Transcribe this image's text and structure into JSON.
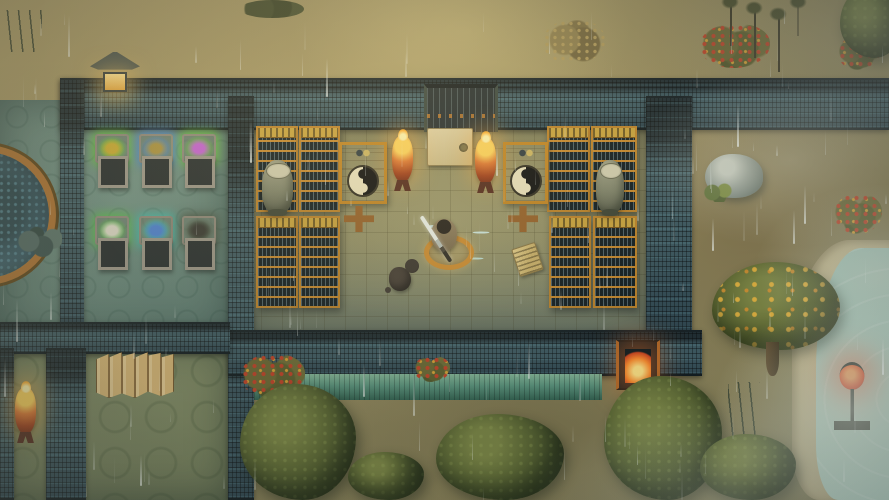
{
  "scene": {
    "view": "top-down-game-scene",
    "weather": "rain",
    "setting": "walled temple compound with scroll library, storage room, courtyard, lake shore"
  },
  "palette": {
    "dirt": "#9c8e5f",
    "wall_tile": "#2c3e46",
    "library_floor": "#8e8960",
    "teal_floor": "#67857a",
    "green_floor": "#7c8660",
    "shelf_gold": "#bd8126",
    "brazier_orange": "#e0772e",
    "lantern_red": "#e5401c",
    "lantern_yellow": "#e8a83c",
    "eave_green": "#579179",
    "water": "#aecfc0",
    "tree_green": "#5c6730",
    "fruit_yellow": "#e2b13c"
  },
  "entities": [
    {
      "type": "floor-teal",
      "name": "west-room-floor",
      "x": 0,
      "y": 100,
      "w": 230,
      "h": 240,
      "z": 1,
      "interactable": false
    },
    {
      "type": "floor-green",
      "name": "south-west-room-floor",
      "x": 0,
      "y": 348,
      "w": 228,
      "h": 152,
      "z": 1,
      "interactable": false
    },
    {
      "type": "floor-library",
      "name": "library-floor",
      "x": 240,
      "y": 118,
      "w": 420,
      "h": 220,
      "z": 1,
      "interactable": false
    },
    {
      "type": "wall",
      "name": "north-wall",
      "x": 60,
      "y": 78,
      "w": 829,
      "h": 52,
      "z": 3,
      "interactable": false
    },
    {
      "type": "wall",
      "name": "west-wall",
      "x": 60,
      "y": 78,
      "w": 24,
      "h": 268,
      "z": 3,
      "interactable": false
    },
    {
      "type": "wall",
      "name": "center-divider-wall",
      "x": 228,
      "y": 96,
      "w": 26,
      "h": 404,
      "z": 3,
      "interactable": false
    },
    {
      "type": "wall",
      "name": "library-east-wall",
      "x": 646,
      "y": 96,
      "w": 46,
      "h": 248,
      "z": 3,
      "interactable": false
    },
    {
      "type": "wall",
      "name": "library-south-wall",
      "x": 228,
      "y": 330,
      "w": 474,
      "h": 46,
      "z": 3,
      "interactable": false
    },
    {
      "type": "wall",
      "name": "southwest-wall-horizontal",
      "x": 0,
      "y": 322,
      "w": 230,
      "h": 32,
      "z": 3,
      "interactable": false
    },
    {
      "type": "wall",
      "name": "southwest-wall-vertical",
      "x": 46,
      "y": 348,
      "w": 40,
      "h": 152,
      "z": 3,
      "interactable": false
    },
    {
      "type": "wall",
      "name": "west-edge-wall",
      "x": 0,
      "y": 348,
      "w": 14,
      "h": 152,
      "z": 3,
      "interactable": false
    },
    {
      "type": "eave",
      "name": "south-wall-green-eave",
      "x": 254,
      "y": 374,
      "w": 348,
      "h": 26,
      "z": 4,
      "interactable": false
    },
    {
      "type": "gate-door",
      "name": "north-gate-door",
      "x": 424,
      "y": 84,
      "w": 74,
      "h": 48,
      "z": 4,
      "interactable": true
    },
    {
      "type": "stone-tablet",
      "name": "gate-stone-tablet",
      "x": 427,
      "y": 128,
      "w": 46,
      "h": 38,
      "z": 5,
      "interactable": true
    },
    {
      "type": "gate-fire",
      "name": "south-gate-burning-brazier",
      "x": 616,
      "y": 340,
      "w": 44,
      "h": 50,
      "z": 5,
      "interactable": true
    },
    {
      "type": "pool",
      "name": "circular-spirit-pool",
      "x": -86,
      "y": 145,
      "w": 142,
      "h": 140,
      "z": 2,
      "interactable": true
    },
    {
      "type": "rock-pile",
      "name": "pool-edge-rocks",
      "x": 16,
      "y": 226,
      "w": 46,
      "h": 34,
      "z": 3,
      "interactable": false
    },
    {
      "type": "stone-lantern",
      "name": "wall-stone-lantern",
      "x": 90,
      "y": 52,
      "w": 50,
      "h": 40,
      "z": 5,
      "interactable": true
    },
    {
      "type": "brazier",
      "name": "library-brazier-left",
      "x": 392,
      "y": 136,
      "w": 21,
      "h": 46,
      "z": 5,
      "interactable": true
    },
    {
      "type": "brazier",
      "name": "library-brazier-right",
      "x": 475,
      "y": 138,
      "w": 21,
      "h": 46,
      "z": 5,
      "interactable": true
    },
    {
      "type": "brazier",
      "name": "southwest-room-brazier",
      "x": 15,
      "y": 388,
      "w": 21,
      "h": 46,
      "z": 5,
      "interactable": true
    },
    {
      "type": "red-lantern",
      "name": "shore-red-lantern",
      "x": 834,
      "y": 362,
      "w": 36,
      "h": 68,
      "z": 8,
      "interactable": true
    },
    {
      "type": "bookshelf",
      "name": "bookshelf-nw-1",
      "x": 256,
      "y": 126,
      "w": 42,
      "h": 86,
      "z": 5,
      "interactable": true
    },
    {
      "type": "bookshelf",
      "name": "bookshelf-nw-2",
      "x": 299,
      "y": 126,
      "w": 41,
      "h": 86,
      "z": 5,
      "interactable": true
    },
    {
      "type": "bookshelf",
      "name": "bookshelf-ne-1",
      "x": 547,
      "y": 126,
      "w": 43,
      "h": 86,
      "z": 5,
      "interactable": true
    },
    {
      "type": "bookshelf",
      "name": "bookshelf-ne-2",
      "x": 591,
      "y": 126,
      "w": 46,
      "h": 86,
      "z": 5,
      "interactable": true
    },
    {
      "type": "bookshelf",
      "name": "bookshelf-sw-1",
      "x": 256,
      "y": 216,
      "w": 42,
      "h": 92,
      "z": 5,
      "interactable": true
    },
    {
      "type": "bookshelf",
      "name": "bookshelf-sw-2",
      "x": 299,
      "y": 216,
      "w": 41,
      "h": 92,
      "z": 5,
      "interactable": true
    },
    {
      "type": "bookshelf",
      "name": "bookshelf-se-1",
      "x": 549,
      "y": 216,
      "w": 42,
      "h": 92,
      "z": 5,
      "interactable": true
    },
    {
      "type": "bookshelf",
      "name": "bookshelf-se-2",
      "x": 593,
      "y": 216,
      "w": 44,
      "h": 92,
      "z": 5,
      "interactable": true
    },
    {
      "type": "yin-desk",
      "name": "taiji-desk-left",
      "x": 339,
      "y": 142,
      "w": 48,
      "h": 62,
      "z": 5,
      "interactable": true
    },
    {
      "type": "chair",
      "name": "desk-chair-left",
      "x": 344,
      "y": 206,
      "w": 30,
      "h": 26,
      "z": 5,
      "interactable": true
    },
    {
      "type": "yin-desk",
      "name": "taiji-desk-right",
      "x": 503,
      "y": 142,
      "w": 45,
      "h": 62,
      "z": 5,
      "interactable": true
    },
    {
      "type": "chair",
      "name": "desk-chair-right",
      "x": 508,
      "y": 206,
      "w": 30,
      "h": 26,
      "z": 5,
      "interactable": true
    },
    {
      "type": "urn",
      "name": "incense-urn-left",
      "x": 262,
      "y": 160,
      "w": 31,
      "h": 54,
      "z": 6,
      "interactable": true
    },
    {
      "type": "urn",
      "name": "incense-urn-right",
      "x": 596,
      "y": 160,
      "w": 28,
      "h": 54,
      "z": 6,
      "interactable": true
    },
    {
      "type": "rack",
      "name": "storage-rack-herb-yellow",
      "x": 95,
      "y": 134,
      "w": 30,
      "h": 54,
      "z": 5,
      "interactable": true,
      "glow": "#63c13d",
      "item": "#c9a92e"
    },
    {
      "type": "rack",
      "name": "storage-rack-blue-glow",
      "x": 139,
      "y": 134,
      "w": 30,
      "h": 54,
      "z": 5,
      "interactable": true,
      "glow": "#4a86c8",
      "item": "#a88f3c"
    },
    {
      "type": "rack",
      "name": "storage-rack-herb-purple",
      "x": 182,
      "y": 134,
      "w": 30,
      "h": 54,
      "z": 5,
      "interactable": true,
      "glow": "#63c13d",
      "item": "#c45fd0"
    },
    {
      "type": "rack",
      "name": "storage-rack-white-item",
      "x": 95,
      "y": 216,
      "w": 30,
      "h": 54,
      "z": 5,
      "interactable": true,
      "glow": "#55b94a",
      "item": "#d9d5c4"
    },
    {
      "type": "rack",
      "name": "storage-rack-teal-glow",
      "x": 139,
      "y": 216,
      "w": 30,
      "h": 54,
      "z": 5,
      "interactable": true,
      "glow": "#3fb9a8",
      "item": "#4a7fd0"
    },
    {
      "type": "rack",
      "name": "storage-rack-dark-cloth",
      "x": 182,
      "y": 216,
      "w": 30,
      "h": 54,
      "z": 5,
      "interactable": true,
      "glow": "#44503f",
      "item": "#35352f"
    },
    {
      "type": "folding-screen",
      "name": "gold-folding-screen",
      "x": 96,
      "y": 352,
      "w": 78,
      "h": 46,
      "z": 5,
      "interactable": true
    },
    {
      "type": "character",
      "name": "player-character-meditating",
      "x": 422,
      "y": 212,
      "w": 44,
      "h": 58,
      "z": 6,
      "interactable": true
    },
    {
      "type": "sword",
      "name": "player-sword",
      "x": 434,
      "y": 212,
      "w": 4,
      "h": 54,
      "z": 7,
      "rot": -33,
      "interactable": false
    },
    {
      "type": "dog",
      "name": "pet-animal",
      "x": 385,
      "y": 256,
      "w": 37,
      "h": 42,
      "z": 6,
      "interactable": true
    },
    {
      "type": "scroll-item",
      "name": "dropped-scroll",
      "x": 515,
      "y": 245,
      "w": 25,
      "h": 29,
      "z": 5,
      "rot": -18,
      "interactable": true
    },
    {
      "type": "boulder",
      "name": "mossy-boulder",
      "x": 705,
      "y": 154,
      "w": 58,
      "h": 44,
      "z": 4,
      "interactable": true
    },
    {
      "type": "shore",
      "name": "lake-shore-sand",
      "x": 792,
      "y": 240,
      "w": 97,
      "h": 260,
      "z": 2,
      "interactable": false
    },
    {
      "type": "water",
      "name": "lake-water",
      "x": 816,
      "y": 248,
      "w": 73,
      "h": 252,
      "z": 3,
      "interactable": false
    },
    {
      "type": "fruit-tree",
      "name": "fruit-tree",
      "x": 712,
      "y": 262,
      "w": 128,
      "h": 88,
      "z": 7,
      "interactable": true
    },
    {
      "type": "tree",
      "name": "tree-southwest",
      "x": 240,
      "y": 384,
      "w": 116,
      "h": 116,
      "z": 7,
      "interactable": true
    },
    {
      "type": "tree",
      "name": "tree-south-small",
      "x": 348,
      "y": 452,
      "w": 76,
      "h": 48,
      "z": 7,
      "interactable": true
    },
    {
      "type": "tree",
      "name": "tree-south-center",
      "x": 436,
      "y": 414,
      "w": 128,
      "h": 86,
      "z": 7,
      "interactable": true
    },
    {
      "type": "tree",
      "name": "tree-south-gate",
      "x": 604,
      "y": 376,
      "w": 118,
      "h": 124,
      "z": 7,
      "interactable": true
    },
    {
      "type": "tree",
      "name": "tree-south-right",
      "x": 700,
      "y": 434,
      "w": 96,
      "h": 66,
      "z": 7,
      "interactable": true
    },
    {
      "type": "tree",
      "name": "tree-northeast-corner",
      "x": 840,
      "y": -14,
      "w": 64,
      "h": 72,
      "z": 7,
      "interactable": true
    },
    {
      "type": "sapling",
      "name": "sapling-1",
      "x": 726,
      "y": 0,
      "w": 10,
      "h": 46,
      "z": 4,
      "interactable": true
    },
    {
      "type": "sapling",
      "name": "sapling-2",
      "x": 750,
      "y": 6,
      "w": 10,
      "h": 52,
      "z": 4,
      "interactable": true
    },
    {
      "type": "sapling",
      "name": "sapling-3",
      "x": 774,
      "y": 12,
      "w": 10,
      "h": 60,
      "z": 4,
      "interactable": true
    },
    {
      "type": "sapling",
      "name": "sapling-4",
      "x": 794,
      "y": 0,
      "w": 8,
      "h": 36,
      "z": 4,
      "interactable": true
    },
    {
      "type": "berry-bush",
      "name": "berry-bush-north-1",
      "x": 700,
      "y": 24,
      "w": 70,
      "h": 44,
      "z": 2,
      "interactable": true
    },
    {
      "type": "berry-bush",
      "name": "berry-bush-north-2",
      "x": 838,
      "y": 36,
      "w": 42,
      "h": 34,
      "z": 2,
      "interactable": true
    },
    {
      "type": "berry-bush",
      "name": "berry-bush-east",
      "x": 834,
      "y": 194,
      "w": 48,
      "h": 40,
      "z": 4,
      "interactable": true
    },
    {
      "type": "berry-bush",
      "name": "berry-bush-courtyard-1",
      "x": 241,
      "y": 354,
      "w": 64,
      "h": 44,
      "z": 4,
      "interactable": true
    },
    {
      "type": "berry-bush",
      "name": "berry-bush-courtyard-2",
      "x": 414,
      "y": 356,
      "w": 36,
      "h": 26,
      "z": 4,
      "interactable": true
    },
    {
      "type": "dry-bush",
      "name": "dry-bush-north",
      "x": 543,
      "y": 20,
      "w": 62,
      "h": 44,
      "z": 2,
      "interactable": true
    },
    {
      "type": "shrub-dark",
      "name": "dark-shrubs-north",
      "x": 240,
      "y": 0,
      "w": 64,
      "h": 18,
      "z": 2,
      "interactable": false
    },
    {
      "type": "reeds",
      "name": "shore-reeds-1",
      "x": 728,
      "y": 382,
      "w": 32,
      "h": 62,
      "z": 4,
      "interactable": false
    },
    {
      "type": "reeds",
      "name": "shore-reeds-2",
      "x": 742,
      "y": 452,
      "w": 26,
      "h": 44,
      "z": 4,
      "interactable": false
    },
    {
      "type": "reeds",
      "name": "corner-plant-northwest",
      "x": 6,
      "y": 10,
      "w": 36,
      "h": 42,
      "z": 2,
      "interactable": false
    }
  ]
}
